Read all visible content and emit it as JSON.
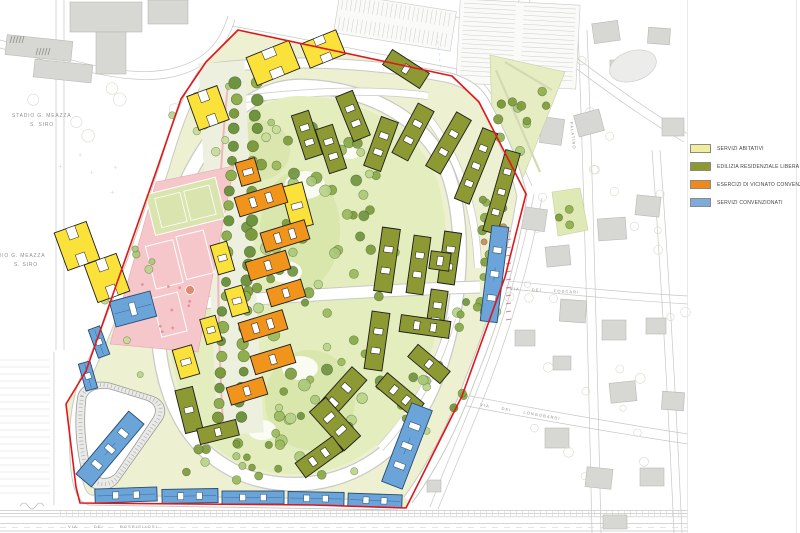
{
  "title": "Urban masterplan with building-use legend",
  "legend": {
    "items": [
      {
        "label": "SERVIZI ABITATIVI",
        "color": "#f1ee9b"
      },
      {
        "label": "EDILIZIA RESIDENZIALE LIBERA",
        "color": "#8d9831"
      },
      {
        "label": "ESERCIZI DI VICINATO CONVENZIONATI",
        "color": "#f0881c"
      },
      {
        "label": "SERVIZI CONVENZIONATI",
        "color": "#7cabdc"
      }
    ]
  },
  "map_labels": {
    "stadium_line1": "STADIO  G.  MEAZZA",
    "stadium_line2": "S. SIRO",
    "via_rospigliosi": "VIA  DEI  ROSPIGLIOSI",
    "via_foscari": "VIA  DEI  FOSCARI",
    "via_longobardi": "VIA  DEI  LONGOBARDI",
    "via_palatino": "PALATINO"
  },
  "colors": {
    "boundary": "#e0161b",
    "residential_olive": "#8d9932",
    "services_yellow": "#fbe23b",
    "retail_orange": "#f0941c",
    "services_blue": "#6ba4d8",
    "sports_pink": "#f5c6ca",
    "site_green": "#edf1d1",
    "park_green": "#e4edbd"
  }
}
